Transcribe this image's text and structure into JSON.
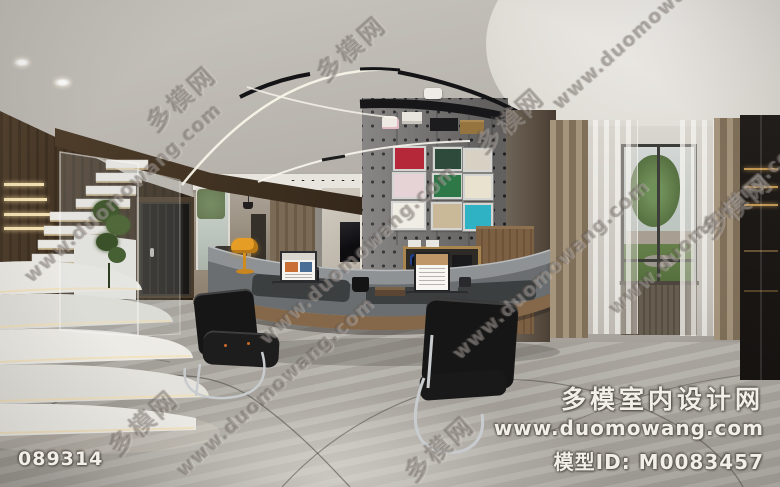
{
  "watermark": {
    "cn": "多模网",
    "url": "www.duomowang.com"
  },
  "footer": {
    "image_code": "089314",
    "site_name": "多模室内设计网",
    "site_url": "www.duomowang.com",
    "model_id": "模型ID: M0083457"
  },
  "scene": {
    "artworks": {
      "a1": "#b5283a",
      "a2": "#2e4a3a",
      "a3": "#d8d0c2",
      "a4": "#e6d3d6",
      "a5": "#2e7747",
      "a6": "#e9e2cf",
      "a7": "#efede4",
      "a8": "#c9b998",
      "a9": "#2fb3c4"
    },
    "colors": {
      "lamp_shade": "#e59d26",
      "desk_top": "#8f9294",
      "desk_wood_trim": "#85684a",
      "pegboard": "#7b7977",
      "chair_leather": "#161616",
      "chrome": "#c9ccce",
      "floor_marble": "#aaa6a0",
      "stair_marble": "#eceae5",
      "wood_wall": "#4a3a2b",
      "drape": "#9a8a72",
      "sheer": "#efece7",
      "window_greens": "#5d7846",
      "cabinet_shelf_glow": "#c79b56",
      "track_light": "#141416"
    }
  }
}
